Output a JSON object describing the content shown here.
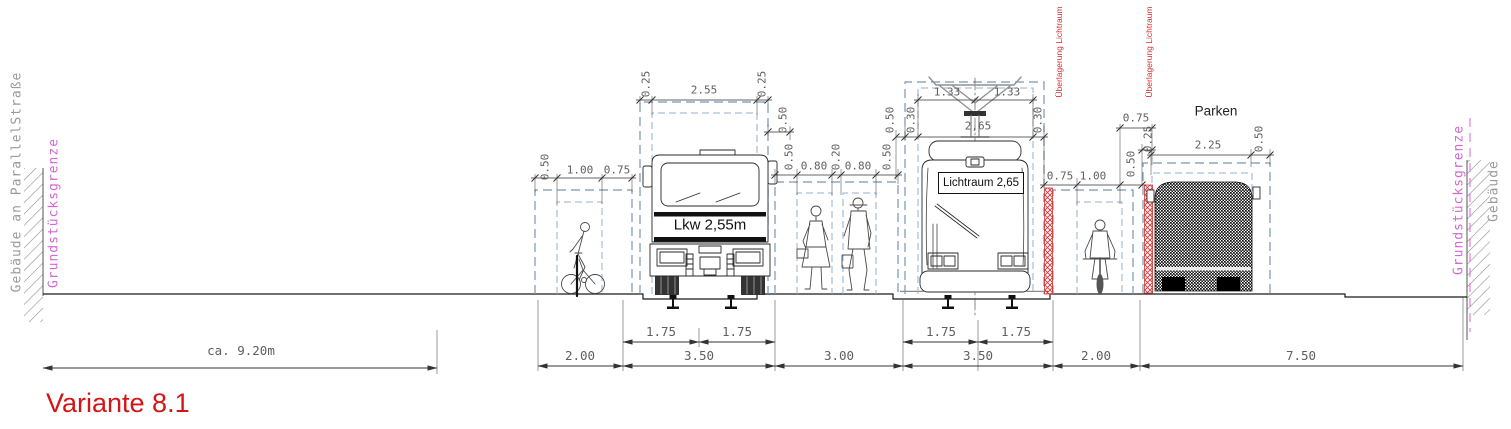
{
  "title": "Variante 8.1",
  "side_labels": {
    "left_building": "Gebäude an ParallelStraße",
    "left_property": "Grundstücksgrenze",
    "right_property": "Grundstücksgrenze",
    "right_building": "Gebäude"
  },
  "red_overlay_label": "Überlagerung Lichtraum",
  "zone_labels": {
    "parking": "Parken",
    "truck": "Lkw 2,55m",
    "tram_clearance": "Lichtraum 2,65"
  },
  "road_sections_m": [
    "2.00",
    "3.50",
    "3.00",
    "3.50",
    "2.00",
    "7.50"
  ],
  "track_half_widths_m": [
    "1.75",
    "1.75",
    "1.75",
    "1.75"
  ],
  "left_forecourt_note": "ca. 9.20m",
  "colors": {
    "titlered": "#d51515",
    "redoverlay": "#d32f2f",
    "magenta": "#d468d4",
    "graytext": "#9a9a9a",
    "dimtext": "#5f5f5f",
    "bluedash": "#7796b4"
  },
  "dim_labels": [
    {
      "t": "0.25",
      "x": 646,
      "y": 84,
      "r": 1
    },
    {
      "t": "2.55",
      "x": 704,
      "y": 90
    },
    {
      "t": "0.25",
      "x": 762,
      "y": 84,
      "r": 1
    },
    {
      "t": "0.50",
      "x": 783,
      "y": 120,
      "r": 1
    },
    {
      "t": "0.50",
      "x": 545,
      "y": 167,
      "r": 1
    },
    {
      "t": "1.00",
      "x": 580,
      "y": 170
    },
    {
      "t": "0.75",
      "x": 617,
      "y": 170
    },
    {
      "t": "0.50",
      "x": 789,
      "y": 157,
      "r": 1
    },
    {
      "t": "0.80",
      "x": 814,
      "y": 166
    },
    {
      "t": "0.20",
      "x": 836,
      "y": 157,
      "r": 1
    },
    {
      "t": "0.80",
      "x": 858,
      "y": 166
    },
    {
      "t": "0.50",
      "x": 887,
      "y": 157,
      "r": 1
    },
    {
      "t": "0.50",
      "x": 890,
      "y": 120,
      "r": 1
    },
    {
      "t": "0.30",
      "x": 911,
      "y": 120,
      "r": 1
    },
    {
      "t": "1.33",
      "x": 947,
      "y": 92
    },
    {
      "t": "1.33",
      "x": 1007,
      "y": 92
    },
    {
      "t": "2,65",
      "x": 978,
      "y": 126
    },
    {
      "t": "0.30",
      "x": 1038,
      "y": 120,
      "r": 1
    },
    {
      "t": "0.75",
      "x": 1060,
      "y": 176
    },
    {
      "t": "1.00",
      "x": 1093,
      "y": 176
    },
    {
      "t": "0.50",
      "x": 1131,
      "y": 164,
      "r": 1
    },
    {
      "t": "0.75",
      "x": 1136,
      "y": 118
    },
    {
      "t": "0.25",
      "x": 1148,
      "y": 139,
      "r": 1
    },
    {
      "t": "2.25",
      "x": 1208,
      "y": 145
    },
    {
      "t": "0.50",
      "x": 1259,
      "y": 139,
      "r": 1
    },
    {
      "t": "1.75",
      "x": 661,
      "y": 332,
      "b": 1
    },
    {
      "t": "1.75",
      "x": 737,
      "y": 332,
      "b": 1
    },
    {
      "t": "1.75",
      "x": 941,
      "y": 332,
      "b": 1
    },
    {
      "t": "1.75",
      "x": 1016,
      "y": 332,
      "b": 1
    },
    {
      "t": "2.00",
      "x": 580,
      "y": 356,
      "b": 1
    },
    {
      "t": "3.50",
      "x": 699,
      "y": 356,
      "b": 1
    },
    {
      "t": "3.00",
      "x": 839,
      "y": 356,
      "b": 1
    },
    {
      "t": "3.50",
      "x": 978,
      "y": 356,
      "b": 1
    },
    {
      "t": "2.00",
      "x": 1096,
      "y": 356,
      "b": 1
    },
    {
      "t": "7.50",
      "x": 1301,
      "y": 356,
      "b": 1
    },
    {
      "t": "ca. 9.20m",
      "x": 241,
      "y": 351,
      "b": 1
    }
  ]
}
